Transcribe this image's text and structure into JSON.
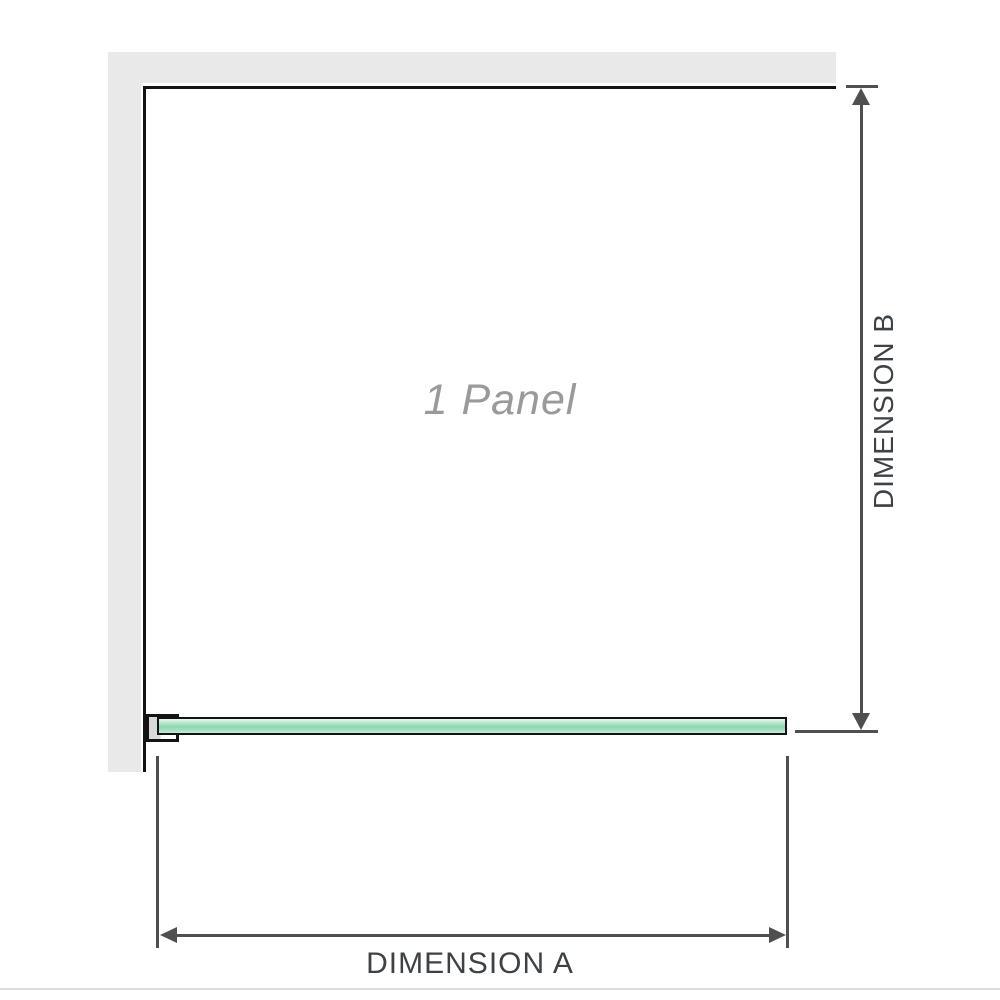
{
  "diagram": {
    "title": "single fixed shower panel dimension diagram",
    "panel_label": "1 Panel",
    "dimension_a_label": "DIMENSION A",
    "dimension_b_label": "DIMENSION B"
  },
  "icons": {
    "dimension_b_arrows": "double-ended-vertical-arrow",
    "dimension_a_arrows": "double-ended-horizontal-arrow"
  },
  "colors": {
    "wall": "#e9e9e9",
    "panel_outline": "#141414",
    "glass_border": "#141414",
    "glass_fill": "#9fd9ba",
    "bracket_fill": "#d9d9d9",
    "dimension_line": "#4f4f4f",
    "label_text": "#3d4247",
    "panel_text": "#9a9a9a",
    "divider": "#dcdcda"
  }
}
